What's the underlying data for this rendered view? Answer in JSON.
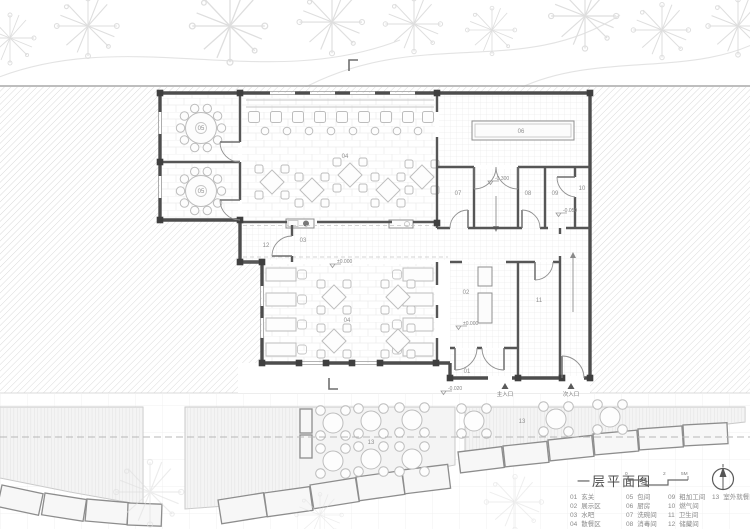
{
  "title_block": {
    "title": "一层平面图",
    "scale_ticks": [
      "0",
      "2",
      "5M"
    ]
  },
  "legend": {
    "items": [
      {
        "num": "01",
        "label": "玄关"
      },
      {
        "num": "02",
        "label": "展示区"
      },
      {
        "num": "03",
        "label": "水吧"
      },
      {
        "num": "04",
        "label": "散餐区"
      },
      {
        "num": "05",
        "label": "包间"
      },
      {
        "num": "06",
        "label": "厨房"
      },
      {
        "num": "07",
        "label": "洗碗间"
      },
      {
        "num": "08",
        "label": "消毒间"
      },
      {
        "num": "09",
        "label": "粗加工间"
      },
      {
        "num": "10",
        "label": "燃气间"
      },
      {
        "num": "11",
        "label": "卫生间"
      },
      {
        "num": "12",
        "label": "储藏间"
      },
      {
        "num": "13",
        "label": "室外就餐区"
      }
    ]
  },
  "plan": {
    "room_labels": [
      {
        "num": "05"
      },
      {
        "num": "05"
      },
      {
        "num": "04"
      },
      {
        "num": "06"
      },
      {
        "num": "07"
      },
      {
        "num": "08"
      },
      {
        "num": "09"
      },
      {
        "num": "10"
      },
      {
        "num": "12"
      },
      {
        "num": "03"
      },
      {
        "num": "04"
      },
      {
        "num": "02"
      },
      {
        "num": "11"
      },
      {
        "num": "01"
      },
      {
        "num": "13"
      },
      {
        "num": "13"
      }
    ],
    "elevation_markers": [
      {
        "text": "±0.000"
      },
      {
        "text": "±0.000"
      },
      {
        "text": "-0.300"
      },
      {
        "text": "-0.050"
      },
      {
        "text": "-0.020"
      }
    ],
    "entrances": [
      {
        "label": "主入口"
      },
      {
        "label": "次入口"
      }
    ]
  }
}
